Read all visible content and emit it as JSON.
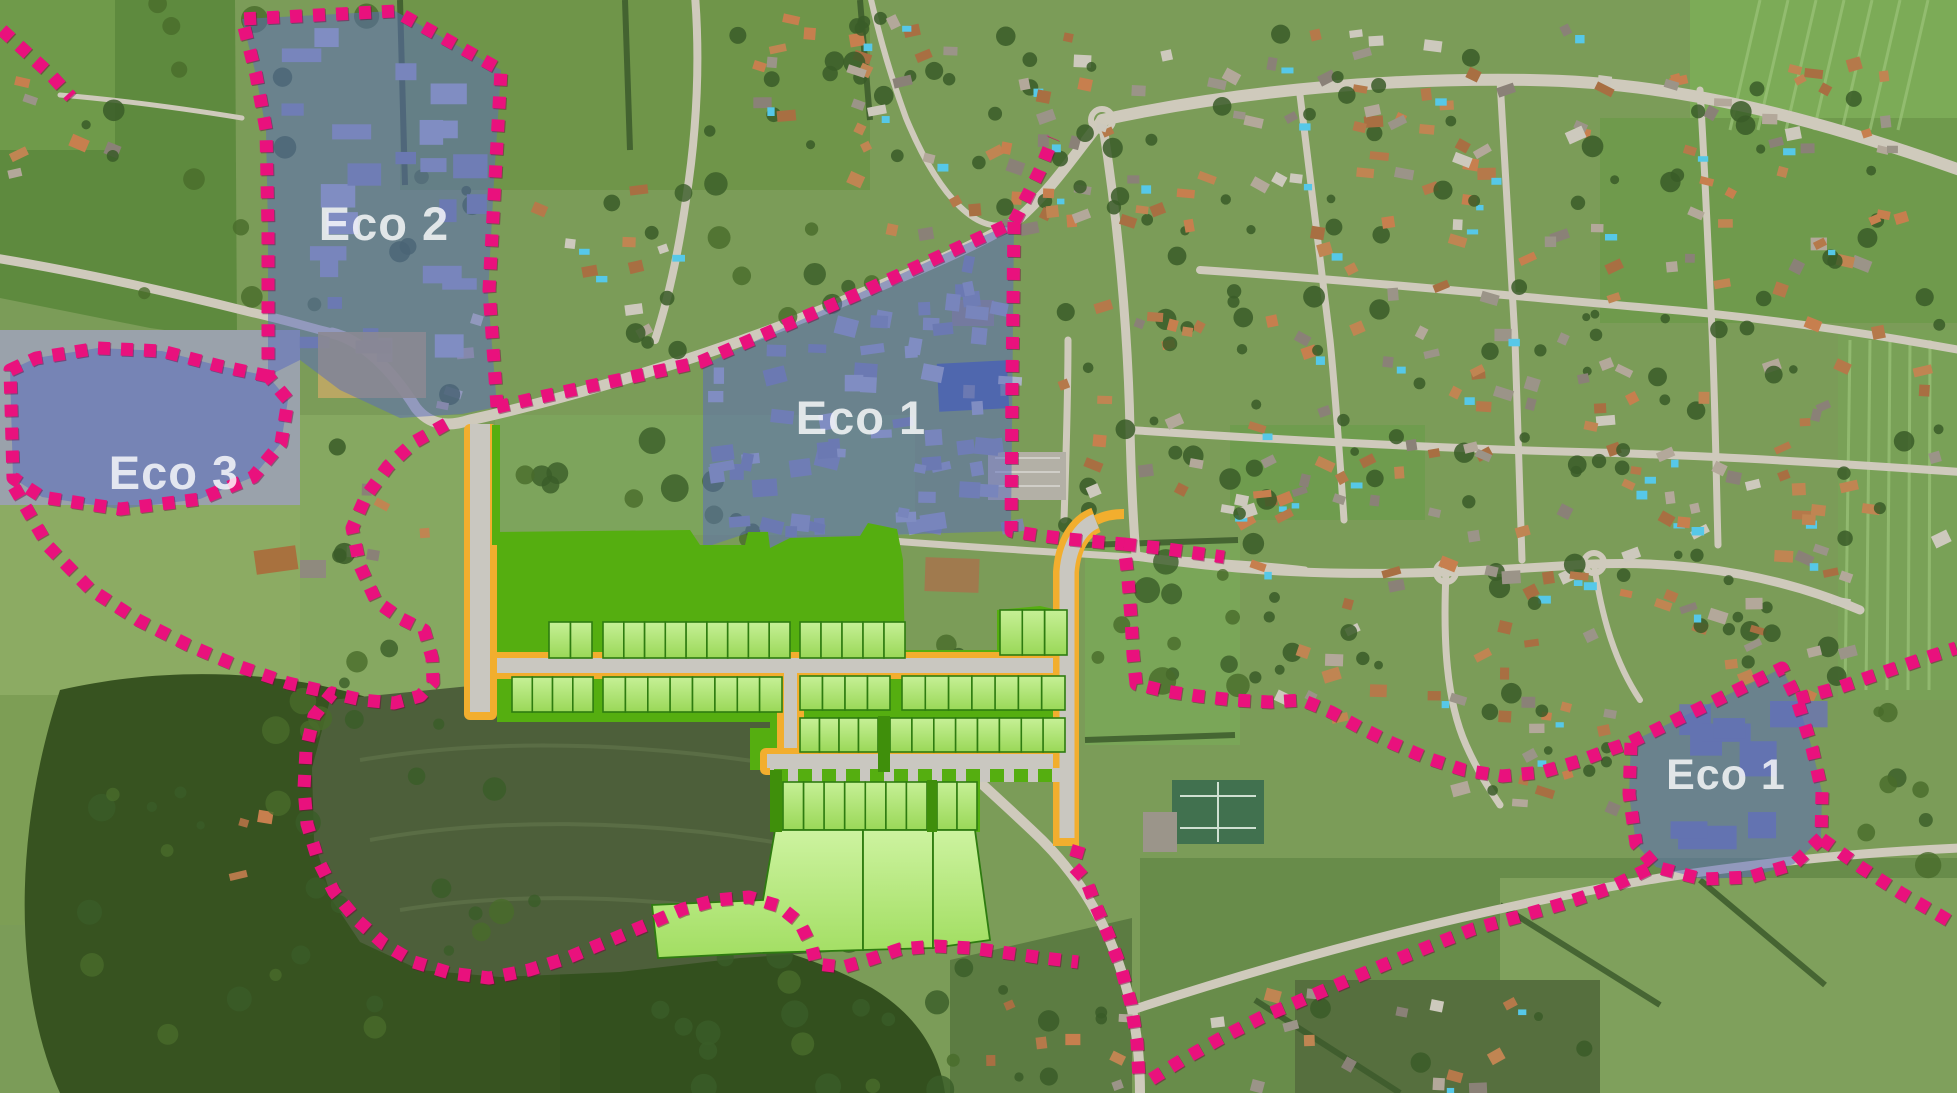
{
  "map": {
    "zones": [
      {
        "id": "eco-2",
        "label": "Eco 2"
      },
      {
        "id": "eco-3",
        "label": "Eco 3"
      },
      {
        "id": "eco-1-main",
        "label": "Eco 1"
      },
      {
        "id": "eco-1-east",
        "label": "Eco 1"
      }
    ],
    "colors": {
      "zone_fill": "#5a6cbd",
      "boundary_pink": "#e9117d",
      "development_green": "#55ae10",
      "plot_fill": "#b4e77e",
      "plot_border": "#2e7c10",
      "road_gray": "#c9c7c0",
      "road_edge_yellow": "#f2ae2e",
      "label_color": "#ffffff"
    }
  }
}
